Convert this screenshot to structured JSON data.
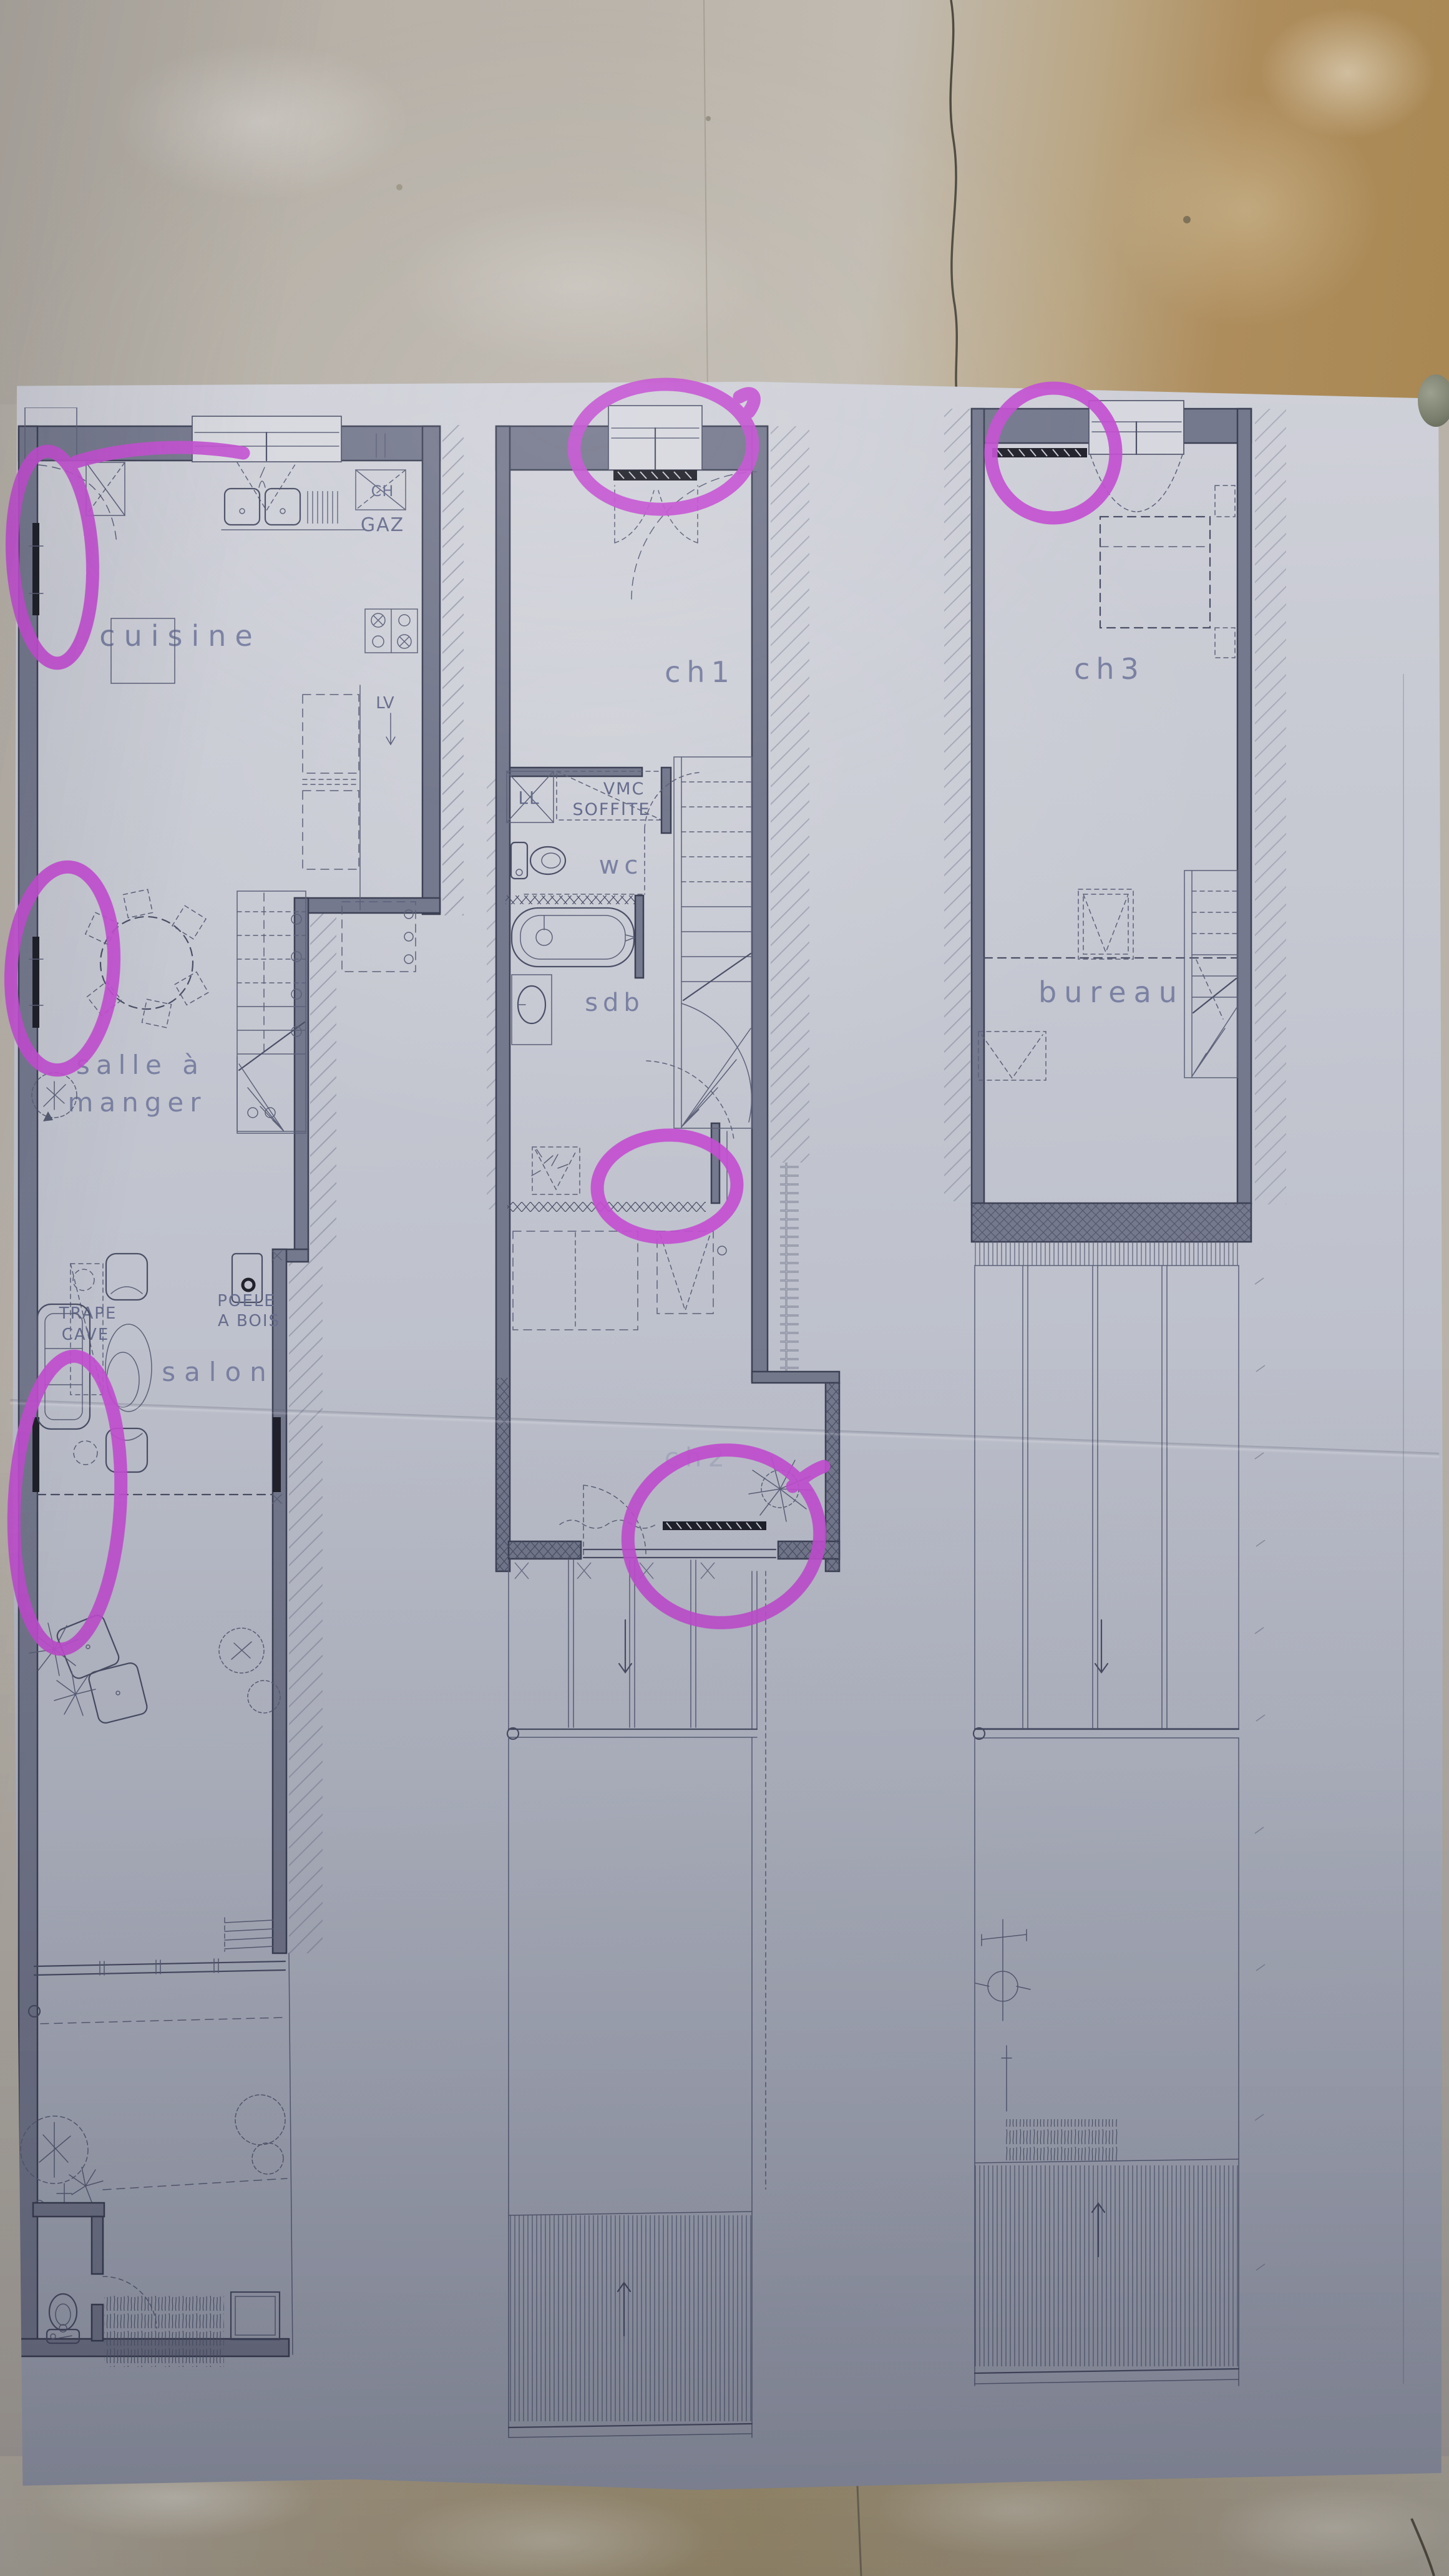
{
  "photo": {
    "description": "architect floor plans on paper, photographed on a stone floor, annotated with magenta marker",
    "marker_color": "#c44fd2"
  },
  "plans": {
    "ground": {
      "kitchen": "cuisine",
      "dining_line1": "salle à",
      "dining_line2": "manger",
      "living": "salon",
      "trap_line1": "TRAPE",
      "trap_line2": "CAVE",
      "stove_line1": "POELE",
      "stove_line2": "A BOIS",
      "boiler": "CH",
      "gas": "GAZ",
      "dishwasher": "LV"
    },
    "first": {
      "bedroom1": "ch1",
      "washer": "LL",
      "vent_line1": "VMC",
      "vent_line2": "SOFFITE",
      "toilet": "wc",
      "bathroom": "sdb",
      "bedroom2": "ch2"
    },
    "second": {
      "bedroom3": "ch3",
      "office": "bureau"
    }
  },
  "annotations": {
    "marker_color": "#c44fd2",
    "circles": [
      {
        "name": "kitchen-left-wall-radiator"
      },
      {
        "name": "dining-left-wall-radiator"
      },
      {
        "name": "living-sofa-and-radiator"
      },
      {
        "name": "bedroom1-window"
      },
      {
        "name": "bathroom-landing-wall"
      },
      {
        "name": "bedroom2-rear-radiator"
      },
      {
        "name": "bedroom3-radiator"
      }
    ]
  }
}
